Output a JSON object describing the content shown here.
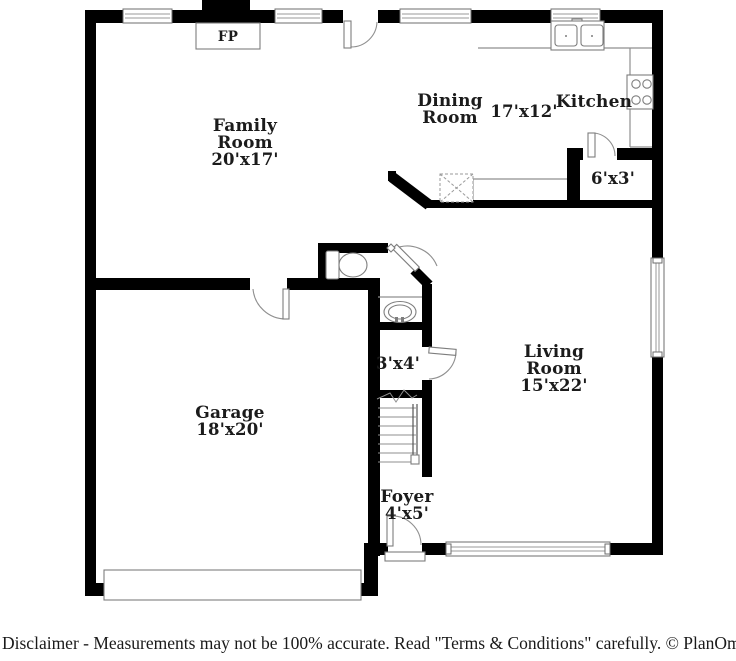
{
  "colors": {
    "background": "#ffffff",
    "wall": "#000000",
    "fixture_line": "#8f8f8f",
    "text": "#1b1b1b"
  },
  "plan": {
    "fireplace_label": "FP",
    "rooms": {
      "family": {
        "lines": [
          "Family",
          "Room"
        ],
        "dims": "20'x17'"
      },
      "dining": {
        "lines": [
          "Dining",
          "Room"
        ],
        "dims": "17'x12'"
      },
      "kitchen": {
        "lines": [
          "Kitchen"
        ]
      },
      "pantry": {
        "dims": "6'x3'"
      },
      "living": {
        "lines": [
          "Living",
          "Room"
        ],
        "dims": "15'x22'"
      },
      "garage": {
        "lines": [
          "Garage"
        ],
        "dims": "18'x20'"
      },
      "half_bath": {
        "dims": "3'x4'"
      },
      "foyer": {
        "lines": [
          "Foyer"
        ],
        "dims": "4'x5'"
      }
    }
  },
  "footer": {
    "disclaimer": "Disclaimer - Measurements may not be 100% accurate. Read \"Terms & Conditions\" carefully.",
    "copyright": "© PlanOmatic"
  }
}
